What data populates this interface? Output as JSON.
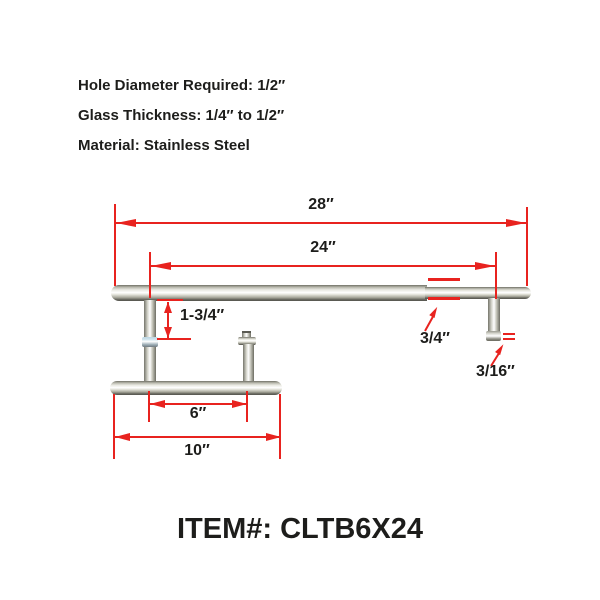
{
  "specs": {
    "hole_diameter": "Hole Diameter Required: 1/2″",
    "glass_thickness": "Glass Thickness: 1/4″ to 1/2″",
    "material": "Material: Stainless Steel"
  },
  "dimensions": {
    "overall_length": "28″",
    "hole_centers": "24″",
    "post_offset": "1-3/4″",
    "bar_diameter": "3/4″",
    "fitting_gap": "3/16″",
    "handle_hole_centers": "6″",
    "handle_length": "10″"
  },
  "item": {
    "label": "ITEM#: CLTB6X24"
  },
  "colors": {
    "dimension_red": "#e8231f",
    "text_black": "#1d1d1b",
    "metal_highlight": "#ffffff",
    "metal_shadow": "#55554e"
  }
}
